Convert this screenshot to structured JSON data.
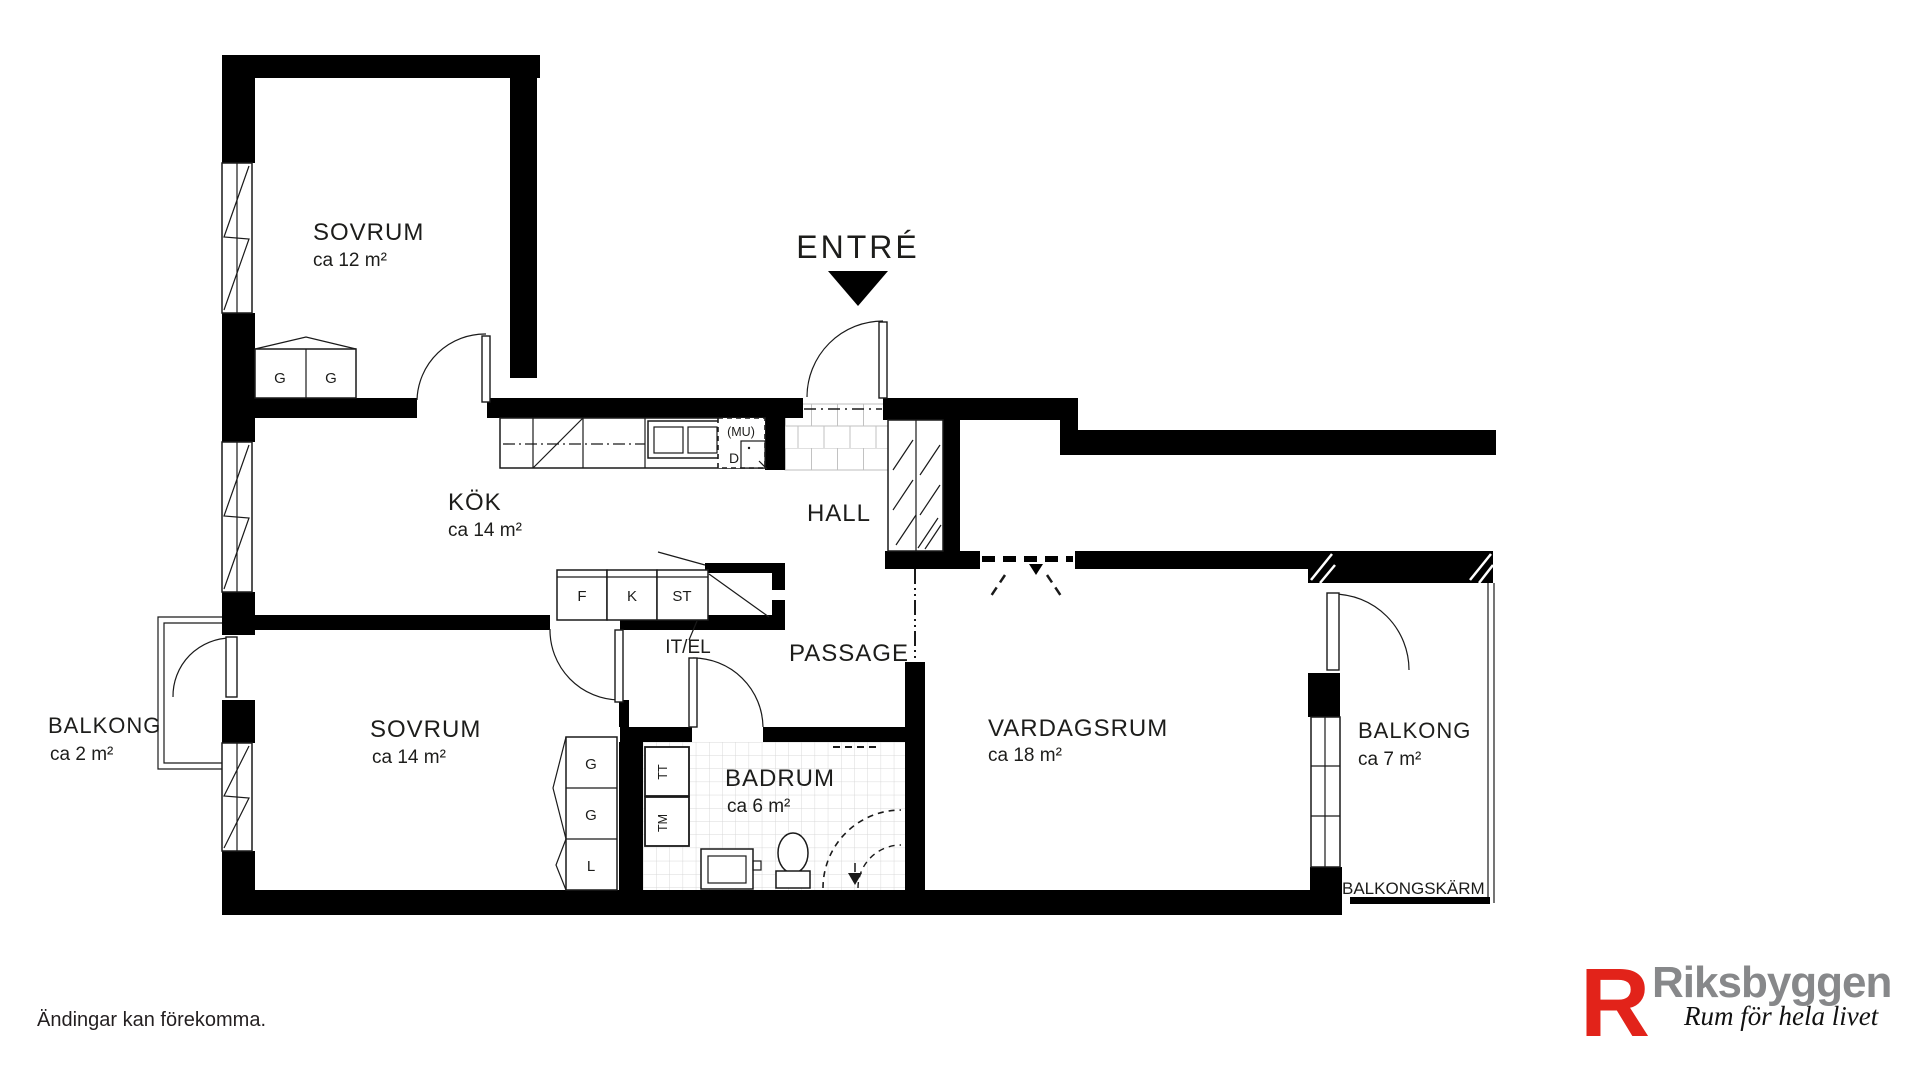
{
  "rooms": {
    "sovrum1": {
      "name": "SOVRUM",
      "area": "ca 12 m²"
    },
    "kok": {
      "name": "KÖK",
      "area": "ca 14 m²"
    },
    "hall": {
      "name": "HALL"
    },
    "passage": {
      "name": "PASSAGE"
    },
    "sovrum2": {
      "name": "SOVRUM",
      "area": "ca 14 m²"
    },
    "badrum": {
      "name": "BADRUM",
      "area": "ca 6 m²"
    },
    "vardagsrum": {
      "name": "VARDAGSRUM",
      "area": "ca 18 m²"
    },
    "balkong_left": {
      "name": "BALKONG",
      "area": "ca 2 m²"
    },
    "balkong_right": {
      "name": "BALKONG",
      "area": "ca 7 m²"
    }
  },
  "labels": {
    "entre": "ENTRÉ",
    "balkongskarm": "BALKONGSKÄRM",
    "it_el": "IT/EL",
    "mu": "(MU)",
    "d": "D",
    "f": "F",
    "k": "K",
    "st": "ST",
    "g": "G",
    "l": "L",
    "tt": "TT",
    "tm": "TM"
  },
  "footer": {
    "disclaimer": "Ändingar kan förekomma."
  },
  "logo": {
    "brand": "Riksbyggen",
    "tagline": "Rum för hela livet",
    "mark_glyph": "R",
    "mark_color": "#e2231a",
    "brand_color": "#87888a"
  }
}
